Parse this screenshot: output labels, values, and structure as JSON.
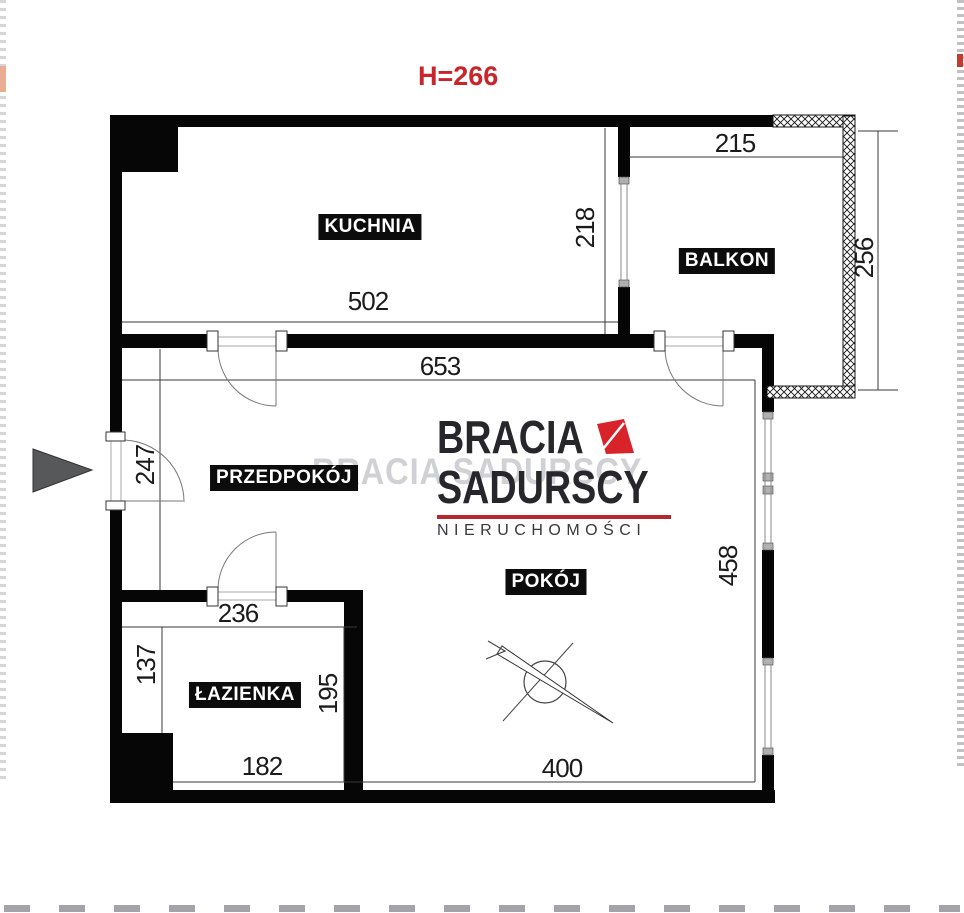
{
  "annotations": {
    "ceiling_height": "H=266"
  },
  "rooms": {
    "kitchen": "KUCHNIA",
    "balcony": "BALKON",
    "hallway": "PRZEDPOKÓJ",
    "room": "POKÓJ",
    "bathroom": "ŁAZIENKA"
  },
  "dims": {
    "kitchen_width": "502",
    "kitchen_height": "218",
    "balcony_width": "215",
    "balcony_height": "256",
    "hall_width": "653",
    "hall_height": "247",
    "bathroom_top_width": "236",
    "bathroom_left_height": "137",
    "bathroom_right_height": "195",
    "bathroom_bottom_width": "182",
    "room_width": "400",
    "room_height": "458"
  },
  "logo": {
    "brand_line1": "BRACIA",
    "brand_line2": "SADURSCY",
    "tagline": "NIERUCHOMOŚCI",
    "ghost_text": "BRACIA SADURSCY"
  },
  "colors": {
    "height_red": "#c9252a",
    "logo_red": "#d8232a",
    "underline_red": "#b5282d",
    "ghost_gray": "#9fa0a8"
  }
}
